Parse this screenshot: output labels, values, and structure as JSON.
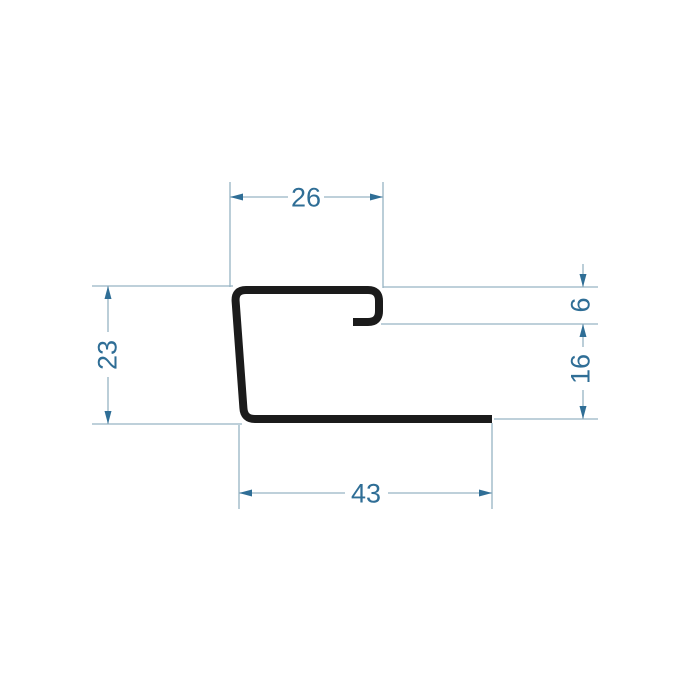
{
  "drawing": {
    "type": "technical-profile-cross-section",
    "dimensions": {
      "top_width": "26",
      "left_height": "23",
      "right_hook_gap": "6",
      "right_lower_height": "16",
      "bottom_width": "43"
    },
    "colors": {
      "profile_outline": "#1b1b1b",
      "dimension_lines": "#96b3c3",
      "dimension_text_and_arrows": "#2f6e96",
      "background": "#ffffff"
    }
  }
}
